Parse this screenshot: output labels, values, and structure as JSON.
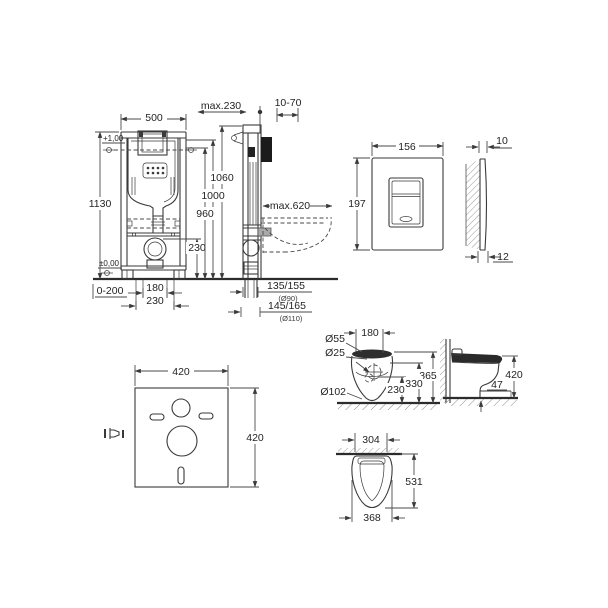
{
  "colors": {
    "line": "#3a3a3a",
    "text": "#242424",
    "dark_fill": "#1b1b1b",
    "background": "#ffffff"
  },
  "frame_front": {
    "width": "500",
    "height": "1130",
    "level_upper": "+1,00",
    "level_floor": "±0,00",
    "outlet_height": "230",
    "foot_adjust": "0-200",
    "drain_spacing": "180",
    "rod_spacing": "230"
  },
  "frame_side": {
    "depth_max": "max.230",
    "wall_offset": "10-70",
    "height_top": "1060",
    "height_mid": "1000",
    "height_cistern": "960",
    "bowl_depth_max": "max.620",
    "drain_a": "135/155",
    "drain_a_pipe": "(Ø90)",
    "drain_b": "145/165",
    "drain_b_pipe": "(Ø110)"
  },
  "flush_plate": {
    "width": "156",
    "height": "197",
    "thickness_top": "10",
    "thickness_bottom": "12"
  },
  "sound_mat": {
    "width": "420",
    "height": "420"
  },
  "bowl_rear": {
    "hole_large": "Ø55",
    "hole_small": "Ø25",
    "hole_spacing": "180",
    "height_top": "365",
    "height_mid": "330",
    "height_low": "230",
    "outlet": "Ø102"
  },
  "bowl_side": {
    "seat_height": "420",
    "step": "47"
  },
  "bowl_top": {
    "wall_width": "304",
    "depth": "531",
    "width": "368"
  }
}
